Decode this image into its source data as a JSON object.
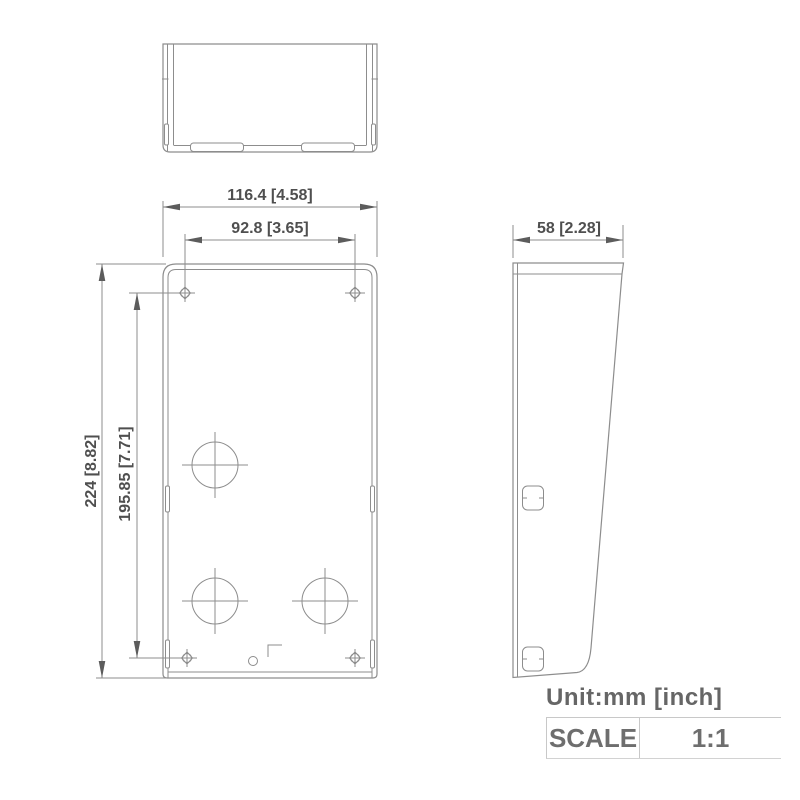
{
  "drawing": {
    "type": "engineering-orthographic-drawing",
    "views": {
      "top_view": "top view of mounting box",
      "front_view": "front view with mounting holes and cable holes",
      "side_view": "side profile with slanted rain-shield face"
    },
    "dimensions": {
      "overall_width": "116.4 [4.58]",
      "mount_hole_spacing_width": "92.8 [3.65]",
      "overall_height": "224 [8.82]",
      "mount_hole_spacing_height": "195.85 [7.71]",
      "depth": "58 [2.28]"
    },
    "footer": {
      "unit_label": "Unit:mm [inch]",
      "scale_label": "SCALE",
      "scale_value": "1:1"
    },
    "colors": {
      "line": "#8d8d8d",
      "dimension_text": "#4f4f4f",
      "footer_text": "#666666",
      "table_border": "#c8c8c8",
      "background": "#ffffff"
    }
  }
}
